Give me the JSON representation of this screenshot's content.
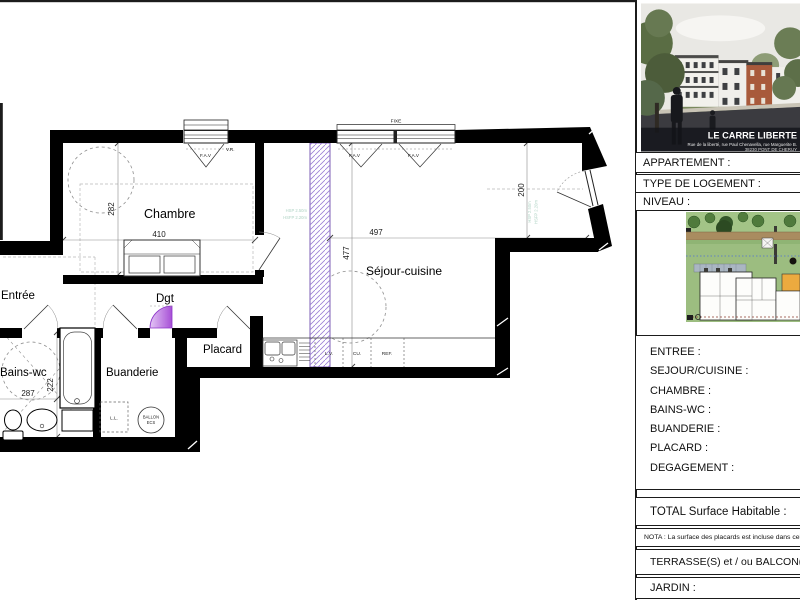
{
  "plan": {
    "rooms": {
      "chambre": "Chambre",
      "sejour": "Séjour-cuisine",
      "entree": "Entrée",
      "dgt": "Dgt",
      "placard": "Placard",
      "bains": "Bains-wc",
      "buanderie": "Buanderie"
    },
    "dims": {
      "chambre_w": "410",
      "chambre_h": "282",
      "sejour_w": "497",
      "sejour_h": "477",
      "sejour_e": "200",
      "bains_w": "287",
      "bains_h": "222"
    },
    "windows": {
      "fixe": "FIXE",
      "fav": "F.A.V",
      "vr": "V.R."
    },
    "kitchen": {
      "lv": "L.V.",
      "cu": "CU.",
      "ref": "REF."
    },
    "equipment": {
      "ll": "L.L.",
      "ballon_1": "BALLON",
      "ballon_2": "ECS"
    },
    "notes": {
      "hsp": "HSP 2.50m",
      "hsfp": "HSFP 2.20m"
    }
  },
  "sidebar": {
    "photo": {
      "title": "LE CARRE LIBERTE",
      "address1": "Rue de la liberté, rue Paul Chenavella, rue Marguerite B.",
      "address2": "38230 PONT DE CHERUY"
    },
    "fields": [
      {
        "label": "APPARTEMENT :"
      },
      {
        "label": "TYPE DE LOGEMENT :"
      },
      {
        "label": "NIVEAU :"
      }
    ],
    "rooms": [
      "ENTREE :",
      "SEJOUR/CUISINE :",
      "CHAMBRE :",
      "BAINS-WC :",
      "BUANDERIE :",
      "PLACARD :",
      "DEGAGEMENT :"
    ],
    "total": "TOTAL Surface Habitable :",
    "nota": "NOTA : La surface des placards est incluse dans celle des pièces",
    "terrasse": "TERRASSE(S) et / ou BALCON(S) :",
    "jardin": "JARDIN :"
  }
}
